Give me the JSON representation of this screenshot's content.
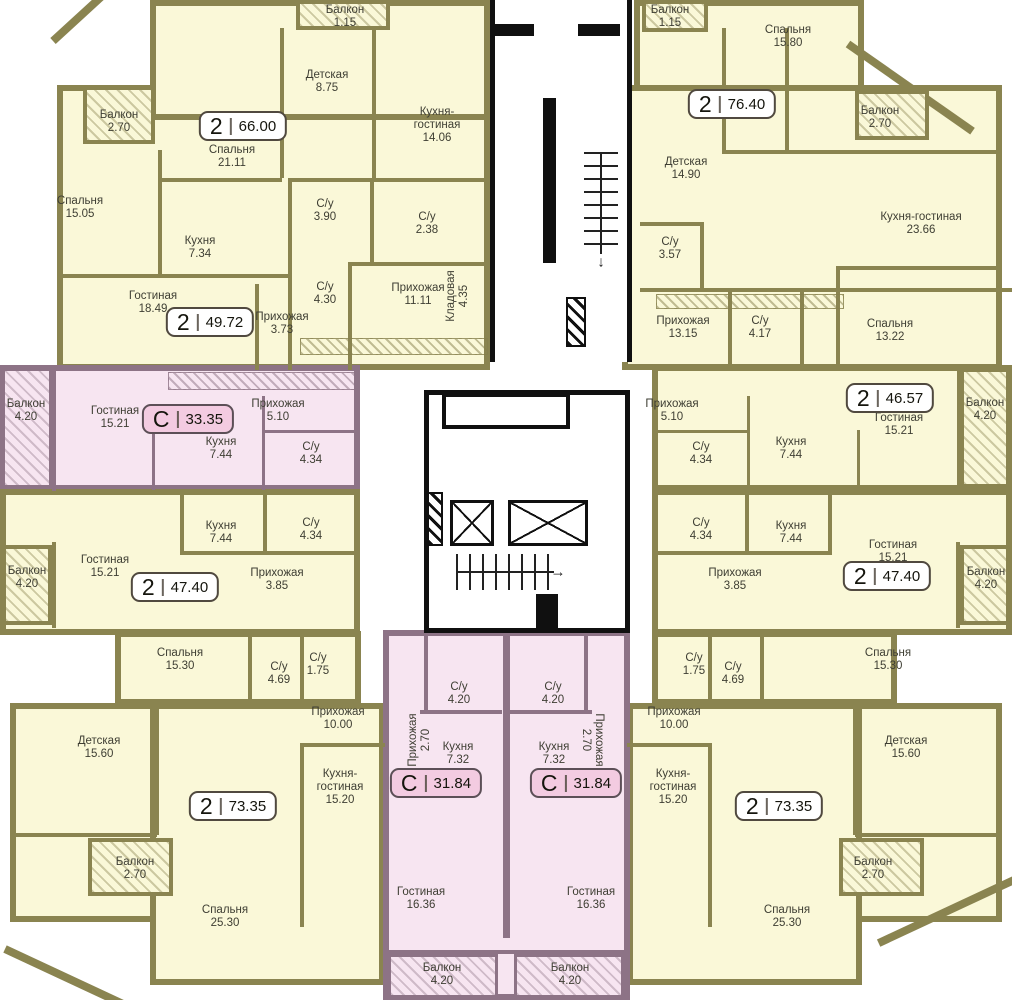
{
  "plan_title": "floor-plan",
  "colors": {
    "apartment_fill": "#FAF8D8",
    "apartment_wall": "#8A8450",
    "studio_fill": "#F7E5F1",
    "studio_wall": "#8D7386",
    "core_wall": "#101010",
    "badge_studio_fill": "#F3CBE1"
  },
  "apartments": [
    {
      "badge": {
        "type": "2",
        "area": "66.00"
      },
      "rooms": [
        {
          "name": "Спальня",
          "area": "21.11"
        },
        {
          "name": "Детская",
          "area": "8.75"
        },
        {
          "name": "Кухня-гостиная",
          "area": "14.06"
        },
        {
          "name": "С/у",
          "area": "3.90"
        },
        {
          "name": "С/у",
          "area": "2.38"
        },
        {
          "name": "Прихожая",
          "area": "11.11"
        },
        {
          "name": "Кладовая",
          "area": "4.35"
        },
        {
          "name": "Балкон",
          "area": "1.15"
        }
      ]
    },
    {
      "badge": {
        "type": "2",
        "area": "49.72"
      },
      "rooms": [
        {
          "name": "Спальня",
          "area": "15.05"
        },
        {
          "name": "Гостиная",
          "area": "18.49"
        },
        {
          "name": "Кухня",
          "area": "7.34"
        },
        {
          "name": "С/у",
          "area": "4.30"
        },
        {
          "name": "Прихожая",
          "area": "3.73"
        },
        {
          "name": "Балкон",
          "area": "2.70"
        }
      ]
    },
    {
      "badge": {
        "type": "С",
        "area": "33.35"
      },
      "rooms": [
        {
          "name": "Гостиная",
          "area": "15.21"
        },
        {
          "name": "Кухня",
          "area": "7.44"
        },
        {
          "name": "С/у",
          "area": "4.34"
        },
        {
          "name": "Прихожая",
          "area": "5.10"
        },
        {
          "name": "Балкон",
          "area": "4.20"
        }
      ]
    },
    {
      "badge": {
        "type": "2",
        "area": "47.40"
      },
      "rooms": [
        {
          "name": "Гостиная",
          "area": "15.21"
        },
        {
          "name": "Кухня",
          "area": "7.44"
        },
        {
          "name": "С/у",
          "area": "4.34"
        },
        {
          "name": "Прихожая",
          "area": "3.85"
        },
        {
          "name": "Спальня",
          "area": "15.30"
        },
        {
          "name": "Балкон",
          "area": "4.20"
        }
      ]
    },
    {
      "badge": {
        "type": "2",
        "area": "73.35"
      },
      "rooms": [
        {
          "name": "Детская",
          "area": "15.60"
        },
        {
          "name": "Кухня-гостиная",
          "area": "15.20"
        },
        {
          "name": "Спальня",
          "area": "25.30"
        },
        {
          "name": "Прихожая",
          "area": "10.00"
        },
        {
          "name": "С/у",
          "area": "4.69"
        },
        {
          "name": "С/у",
          "area": "1.75"
        },
        {
          "name": "Балкон",
          "area": "2.70"
        }
      ]
    },
    {
      "badge": {
        "type": "С",
        "area": "31.84"
      },
      "rooms": [
        {
          "name": "Гостиная",
          "area": "16.36"
        },
        {
          "name": "Кухня",
          "area": "7.32"
        },
        {
          "name": "С/у",
          "area": "4.20"
        },
        {
          "name": "Прихожая",
          "area": "2.70"
        },
        {
          "name": "Балкон",
          "area": "4.20"
        }
      ]
    },
    {
      "badge": {
        "type": "С",
        "area": "31.84"
      },
      "rooms": [
        {
          "name": "Гостиная",
          "area": "16.36"
        },
        {
          "name": "Кухня",
          "area": "7.32"
        },
        {
          "name": "С/у",
          "area": "4.20"
        },
        {
          "name": "Прихожая",
          "area": "2.70"
        },
        {
          "name": "Балкон",
          "area": "4.20"
        }
      ]
    },
    {
      "badge": {
        "type": "2",
        "area": "73.35"
      },
      "rooms": [
        {
          "name": "Детская",
          "area": "15.60"
        },
        {
          "name": "Кухня-гостиная",
          "area": "15.20"
        },
        {
          "name": "Спальня",
          "area": "25.30"
        },
        {
          "name": "Прихожая",
          "area": "10.00"
        },
        {
          "name": "С/у",
          "area": "4.69"
        },
        {
          "name": "С/у",
          "area": "1.75"
        },
        {
          "name": "Балкон",
          "area": "2.70"
        }
      ]
    },
    {
      "badge": {
        "type": "2",
        "area": "47.40"
      },
      "rooms": [
        {
          "name": "Гостиная",
          "area": "15.21"
        },
        {
          "name": "Кухня",
          "area": "7.44"
        },
        {
          "name": "С/у",
          "area": "4.34"
        },
        {
          "name": "Прихожая",
          "area": "3.85"
        },
        {
          "name": "Спальня",
          "area": "15.30"
        },
        {
          "name": "Балкон",
          "area": "4.20"
        }
      ]
    },
    {
      "badge": {
        "type": "2",
        "area": "46.57"
      },
      "rooms": [
        {
          "name": "Гостиная",
          "area": "15.21"
        },
        {
          "name": "Спальня",
          "area": "13.22"
        },
        {
          "name": "Кухня",
          "area": "7.44"
        },
        {
          "name": "С/у",
          "area": "4.34"
        },
        {
          "name": "Прихожая",
          "area": "5.10"
        },
        {
          "name": "Балкон",
          "area": "4.20"
        }
      ]
    },
    {
      "badge": {
        "type": "2",
        "area": "76.40"
      },
      "rooms": [
        {
          "name": "Спальня",
          "area": "15.80"
        },
        {
          "name": "Детская",
          "area": "14.90"
        },
        {
          "name": "Кухня-гостиная",
          "area": "23.66"
        },
        {
          "name": "Прихожая",
          "area": "13.15"
        },
        {
          "name": "С/у",
          "area": "3.57"
        },
        {
          "name": "С/у",
          "area": "4.17"
        },
        {
          "name": "Балкон",
          "area": "1.15"
        },
        {
          "name": "Балкон",
          "area": "2.70"
        }
      ]
    }
  ]
}
